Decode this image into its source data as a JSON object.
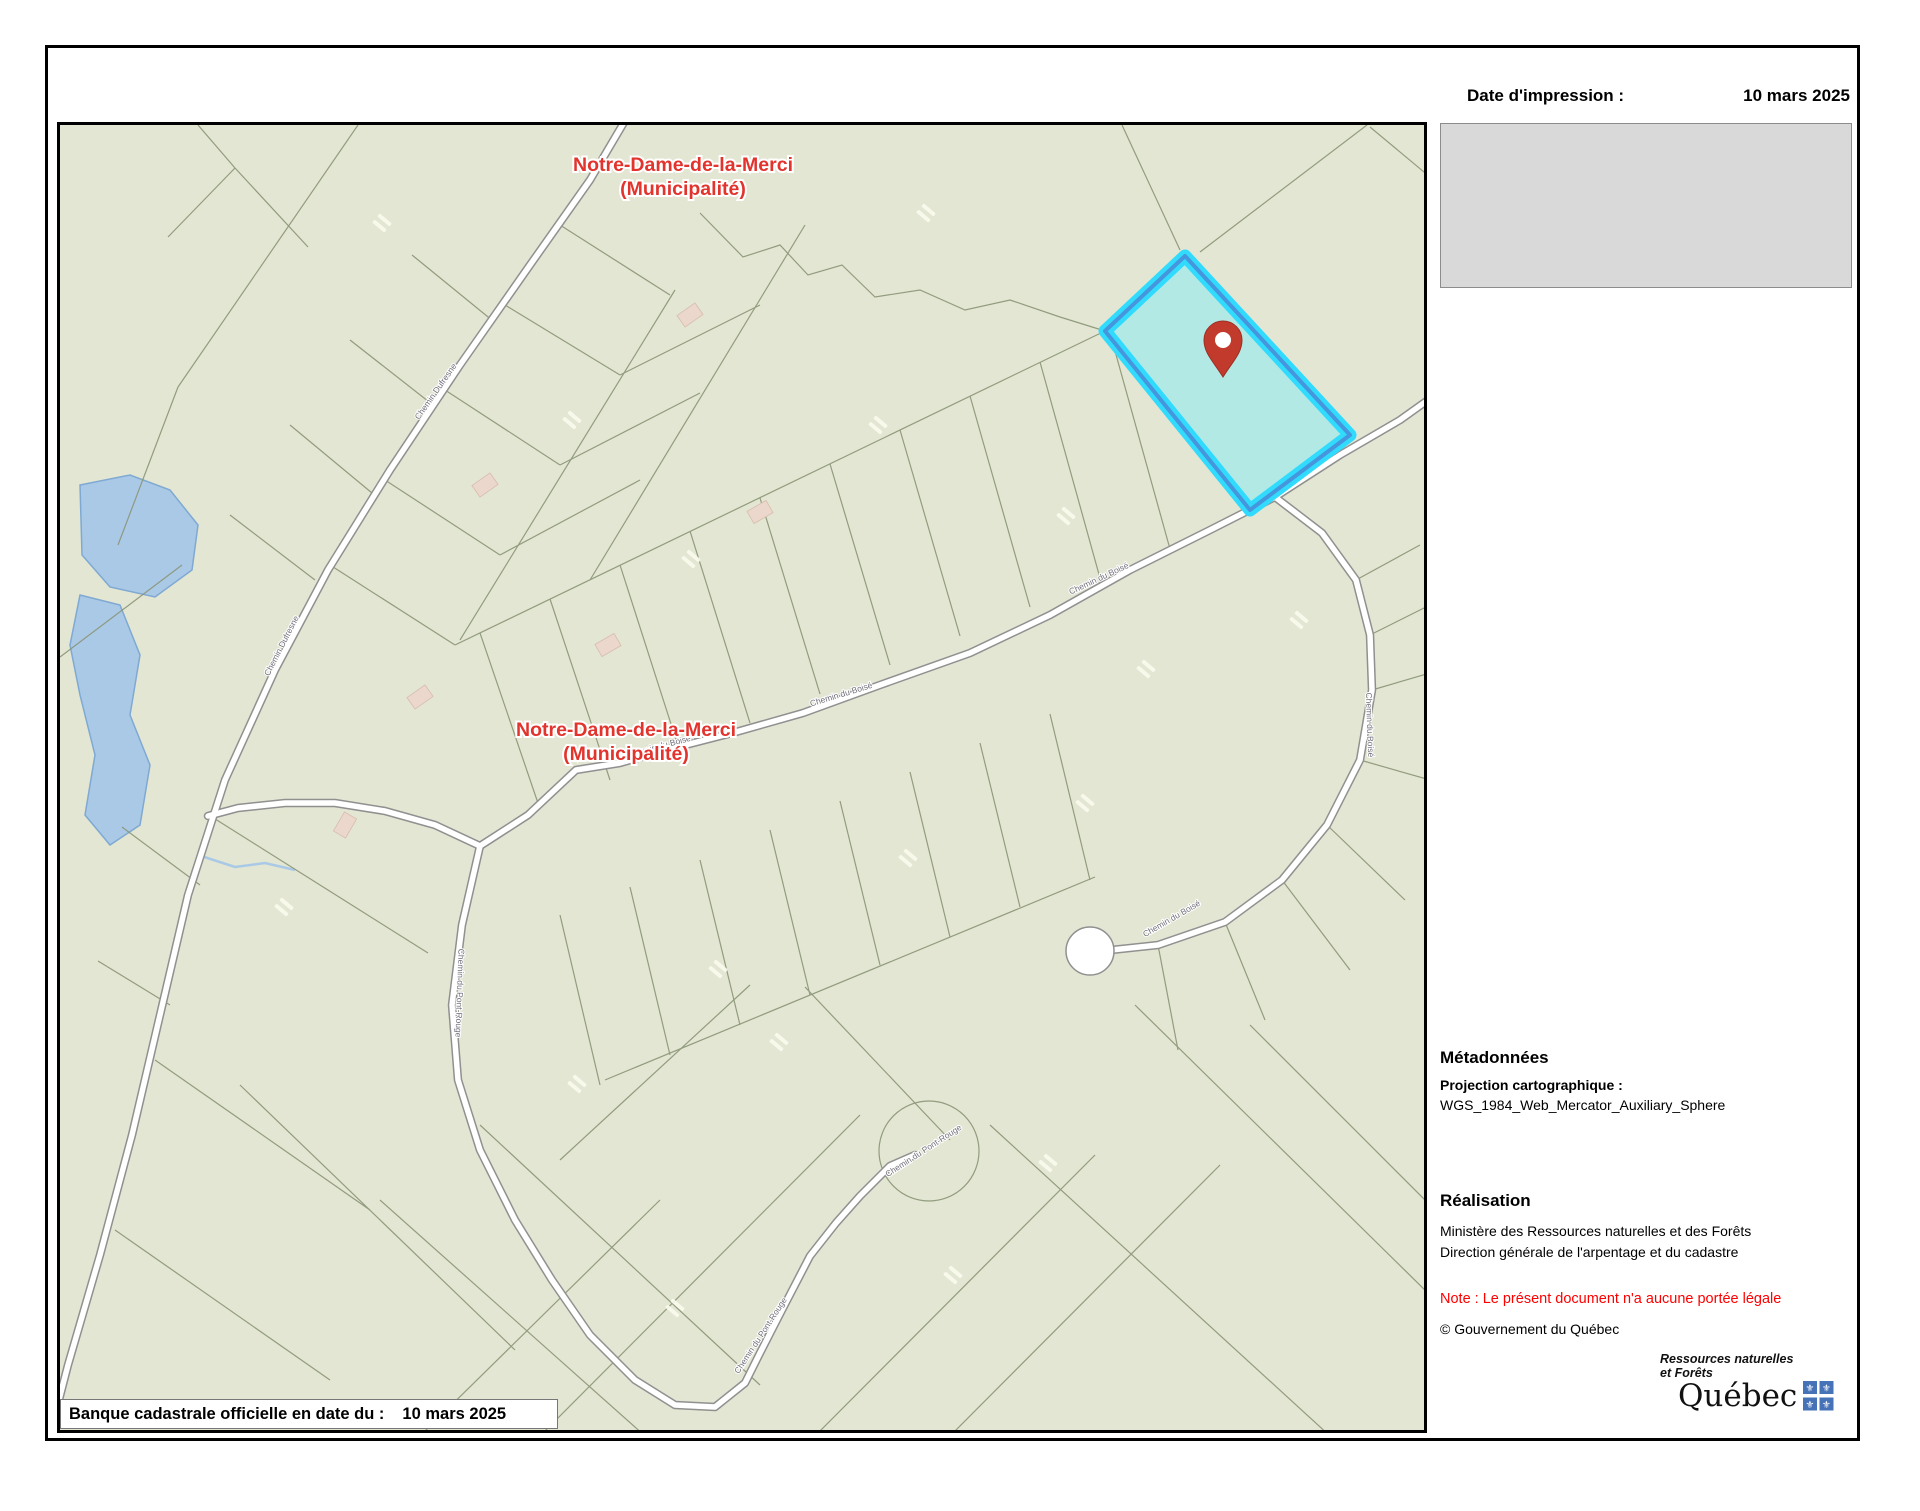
{
  "header": {
    "print_date_label": "Date d'impression :",
    "print_date_value": "10 mars 2025"
  },
  "cadastre_strip": {
    "label": "Banque cadastrale officielle en date du :",
    "value": "10 mars 2025"
  },
  "metadata": {
    "heading": "Métadonnées",
    "projection_label": "Projection cartographique :",
    "projection_value": "WGS_1984_Web_Mercator_Auxiliary_Sphere"
  },
  "realisation": {
    "heading": "Réalisation",
    "line1": "Ministère des Ressources naturelles et des Forêts",
    "line2": "Direction générale de l'arpentage et du cadastre",
    "note": "Note : Le présent document n'a aucune portée légale",
    "copyright": "© Gouvernement du Québec"
  },
  "logo": {
    "line1": "Ressources naturelles",
    "line2": "et Forêts",
    "wordmark": "Québec",
    "flag_blue": "#4673b8",
    "fleur_glyph": "⚜"
  },
  "map": {
    "colors": {
      "background": "#e2e6d2",
      "parcel_line": "#8a9476",
      "road_casing": "#909090",
      "road_fill": "#ffffff",
      "water_fill": "#a9c9e7",
      "water_stroke": "#7fa9d2",
      "building_pink": "#ecd7cd",
      "building_pink_stroke": "#d8bcae",
      "bar_white": "#fbfbee",
      "highlight_fill": "#b2e9e5",
      "highlight_cyan": "#31dbfd",
      "highlight_blue": "#4596dc",
      "pin_red": "#c23a2c",
      "municipality_red": "#e2332d",
      "road_label": "#70707c"
    },
    "municipality_labels": [
      {
        "line1": "Notre-Dame-de-la-Merci",
        "line2": "(Municipalité)",
        "x": 623,
        "y": 46
      },
      {
        "line1": "Notre-Dame-de-la-Merci",
        "line2": "(Municipalité)",
        "x": 566,
        "y": 611
      }
    ],
    "roads": [
      {
        "name": "Chemin Dufresne",
        "path": "M 566,-6 L 530,55 470,140 400,240 330,345 268,445 215,545 165,655 128,770 100,890 72,1010 40,1130 8,1240 -8,1302"
      },
      {
        "name": "connector",
        "path": "M 420,721 L 375,700 325,686 275,678 225,678 178,683 148,691"
      },
      {
        "name": "Chemin du Boisé",
        "path": "M 420,721 L 468,690 516,645 560,638 606,625 676,607 743,588 820,560 910,528 990,490 1070,445 1150,405 1215,372 1280,330 1340,295 1375,270"
      },
      {
        "name": "Chemin du Boisé (branche)",
        "path": "M 1215,372 L 1262,408 1296,455 1310,510 1312,565 1300,635 1267,700 1222,755 1165,797 1098,820 1042,826"
      },
      {
        "name": "Chemin du Pont-Rouge",
        "path": "M 420,721 L 402,800 392,880 398,955 420,1025 455,1095 492,1155 530,1210 575,1255 615,1280 655,1282 685,1258 700,1228 722,1185 750,1131 776,1098 800,1071 830,1041 855,1030"
      }
    ],
    "culdesac": {
      "cx": 1030,
      "cy": 826,
      "r": 24
    },
    "teardrop": {
      "cx": 869,
      "cy": 1026,
      "r": 50
    },
    "road_labels": [
      {
        "x": 378,
        "y": 268,
        "rot": -55,
        "text": "Chemin Dufresne"
      },
      {
        "x": 224,
        "y": 522,
        "rot": -63,
        "text": "Chemin Dufresne"
      },
      {
        "x": 600,
        "y": 624,
        "rot": -15,
        "text": "Chemin du Boisé"
      },
      {
        "x": 782,
        "y": 572,
        "rot": -17,
        "text": "Chemin du Boisé"
      },
      {
        "x": 1040,
        "y": 456,
        "rot": -25,
        "text": "Chemin du Boisé"
      },
      {
        "x": 1307,
        "y": 600,
        "rot": 88,
        "text": "Chemin du Boisé"
      },
      {
        "x": 1113,
        "y": 796,
        "rot": -30,
        "text": "Chemin du Boisé"
      },
      {
        "x": 865,
        "y": 1028,
        "rot": -33,
        "text": "Chemin du Pont-Rouge"
      },
      {
        "x": 703,
        "y": 1212,
        "rot": -57,
        "text": "Chemin du Pont-Rouge"
      },
      {
        "x": 397,
        "y": 868,
        "rot": 92,
        "text": "Chemin du Pont-Rouge"
      }
    ],
    "water": [
      "M20,360 L70,350 110,365 138,400 132,445 95,472 50,462 22,430 Z",
      "M20,470 L60,480 80,530 70,590 90,640 80,700 50,720 25,690 35,630 20,570 10,520 Z"
    ],
    "stream": "M138,730 L175,742 205,738 235,745",
    "boundary_paths": [
      "M 640,88 L 683,132 720,120 748,150 782,140 815,172 860,165 905,185 950,175 1000,192 1045,206"
    ],
    "parcel_lines": [
      [
        1307,
        0,
        1140,
        127
      ],
      [
        1310,
        2,
        1370,
        52
      ],
      [
        1120,
        125,
        1062,
        0
      ],
      [
        138,
        0,
        175,
        43
      ],
      [
        175,
        43,
        108,
        112
      ],
      [
        175,
        43,
        248,
        122
      ],
      [
        395,
        520,
        1045,
        206
      ],
      [
        480,
        684,
        420,
        508
      ],
      [
        550,
        655,
        490,
        474
      ],
      [
        620,
        627,
        560,
        440
      ],
      [
        690,
        598,
        630,
        406
      ],
      [
        760,
        569,
        700,
        373
      ],
      [
        830,
        540,
        770,
        339
      ],
      [
        900,
        511,
        840,
        305
      ],
      [
        970,
        482,
        910,
        271
      ],
      [
        1040,
        453,
        980,
        237
      ],
      [
        1110,
        424,
        1050,
        208
      ],
      [
        500,
        790,
        540,
        960
      ],
      [
        570,
        762,
        610,
        930
      ],
      [
        640,
        735,
        680,
        900
      ],
      [
        710,
        705,
        750,
        870
      ],
      [
        780,
        676,
        820,
        840
      ],
      [
        850,
        647,
        890,
        812
      ],
      [
        920,
        618,
        960,
        782
      ],
      [
        990,
        589,
        1030,
        755
      ],
      [
        545,
        955,
        1035,
        752
      ],
      [
        420,
        1000,
        700,
        1260
      ],
      [
        320,
        1075,
        585,
        1311
      ],
      [
        180,
        960,
        455,
        1225
      ],
      [
        480,
        1311,
        800,
        990
      ],
      [
        690,
        860,
        500,
        1035
      ],
      [
        745,
        862,
        890,
        1015
      ],
      [
        360,
        1311,
        600,
        1075
      ],
      [
        755,
        1311,
        1035,
        1030
      ],
      [
        890,
        1311,
        1160,
        1040
      ],
      [
        1312,
        565,
        1370,
        548
      ],
      [
        1300,
        635,
        1370,
        655
      ],
      [
        1267,
        700,
        1345,
        775
      ],
      [
        1222,
        755,
        1290,
        845
      ],
      [
        1165,
        797,
        1205,
        895
      ],
      [
        1098,
        820,
        1118,
        925
      ],
      [
        1310,
        510,
        1370,
        480
      ],
      [
        1296,
        455,
        1360,
        420
      ],
      [
        1075,
        880,
        1370,
        1170
      ],
      [
        930,
        1000,
        1270,
        1311
      ],
      [
        1190,
        900,
        1370,
        1080
      ],
      [
        433,
        196,
        352,
        130
      ],
      [
        373,
        280,
        290,
        215
      ],
      [
        312,
        368,
        230,
        300
      ],
      [
        255,
        455,
        170,
        390
      ],
      [
        500,
        100,
        610,
        170
      ],
      [
        445,
        180,
        560,
        250
      ],
      [
        385,
        265,
        500,
        340
      ],
      [
        325,
        355,
        440,
        430
      ],
      [
        270,
        440,
        395,
        520
      ],
      [
        615,
        165,
        400,
        515
      ],
      [
        745,
        100,
        530,
        455
      ],
      [
        560,
        250,
        700,
        180
      ],
      [
        500,
        340,
        640,
        268
      ],
      [
        440,
        430,
        580,
        355
      ],
      [
        298,
        0,
        118,
        262
      ],
      [
        118,
        262,
        58,
        420
      ],
      [
        0,
        532,
        122,
        440
      ],
      [
        152,
        692,
        368,
        828
      ],
      [
        95,
        935,
        310,
        1085
      ],
      [
        55,
        1105,
        270,
        1255
      ],
      [
        140,
        760,
        62,
        702
      ],
      [
        110,
        880,
        38,
        836
      ]
    ],
    "pink_buildings": [
      [
        630,
        190,
        -35
      ],
      [
        425,
        360,
        -35
      ],
      [
        700,
        387,
        -30
      ],
      [
        548,
        520,
        -30
      ],
      [
        360,
        572,
        -35
      ],
      [
        285,
        700,
        -60
      ]
    ],
    "white_bars": [
      [
        866,
        88
      ],
      [
        322,
        98
      ],
      [
        512,
        295
      ],
      [
        631,
        434
      ],
      [
        818,
        300
      ],
      [
        1006,
        391
      ],
      [
        1086,
        544
      ],
      [
        1025,
        678
      ],
      [
        848,
        733
      ],
      [
        658,
        844
      ],
      [
        517,
        959
      ],
      [
        719,
        917
      ],
      [
        1239,
        495
      ],
      [
        224,
        782
      ],
      [
        615,
        1183
      ],
      [
        893,
        1150
      ],
      [
        988,
        1038
      ]
    ],
    "highlight_polygon": "1125,131 1290,310 1190,385 1045,206",
    "pin": {
      "x": 1163,
      "y": 252
    }
  }
}
